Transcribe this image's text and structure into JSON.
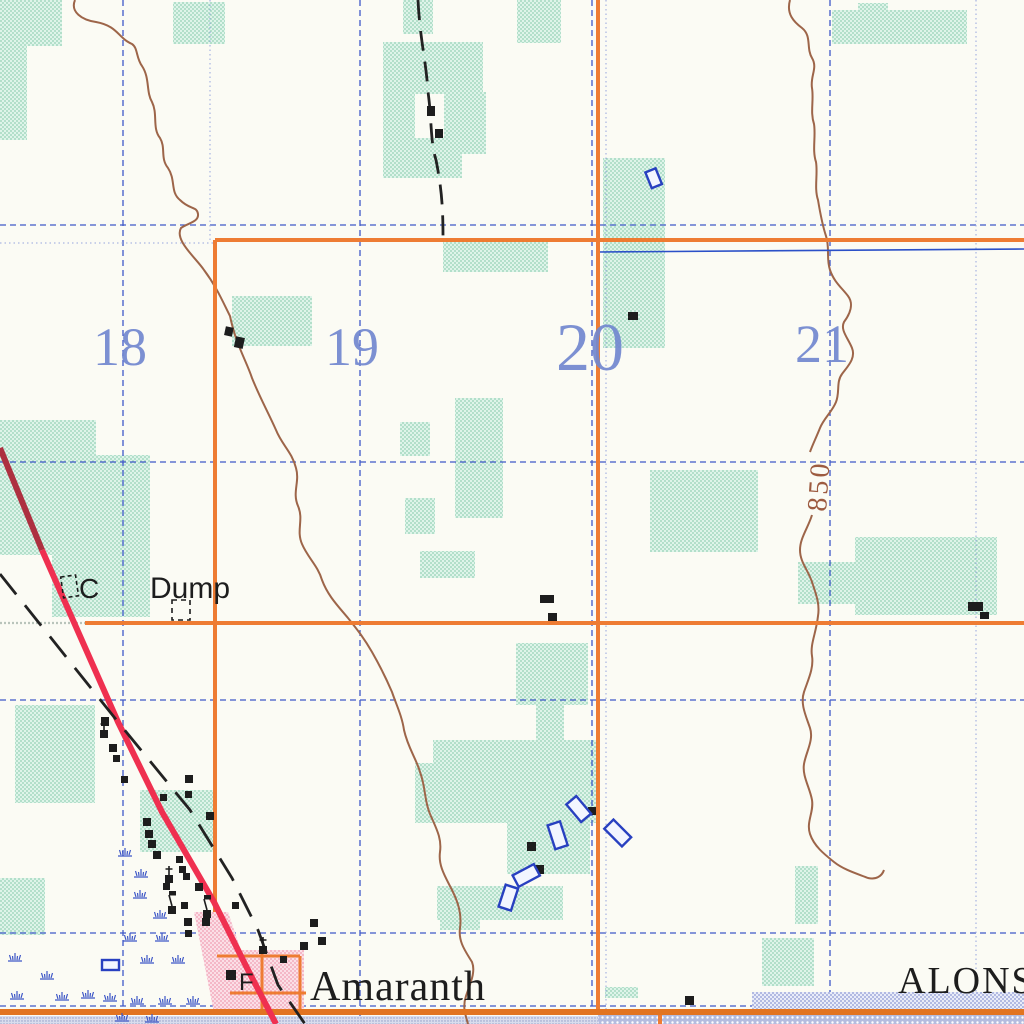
{
  "map": {
    "place_labels": {
      "town": "Amaranth",
      "municipality": "ALONSA"
    },
    "feature_labels": {
      "dump": "Dump",
      "cemetery_abbrev": "C",
      "f_building": "F"
    },
    "contour_label": "850",
    "section_numbers": [
      {
        "value": "18"
      },
      {
        "value": "19"
      },
      {
        "value": "20"
      },
      {
        "value": "21"
      }
    ],
    "symbols": {
      "church": "church-cross-symbol",
      "school": "school-flag-symbol",
      "marsh": "marsh-tuft-symbol",
      "building": "building-square-symbol",
      "dump_site": "dump-site-dashed-outline",
      "cemetery": "cemetery-dashed-outline"
    },
    "colors": {
      "background": "#fbfbf4",
      "vegetation": "#cdeedd",
      "grid_blue": "#3f58c8",
      "road_orange": "#ee7c33",
      "highway_red": "#ef3050",
      "highway_dark_red": "#ad3040",
      "contour_brown": "#9d6549",
      "built_up_pink": "#f6b9c6",
      "water_blue": "#2b50c8",
      "feature_black": "#1d1d1d",
      "section_number_blue": "#7288d0"
    }
  }
}
